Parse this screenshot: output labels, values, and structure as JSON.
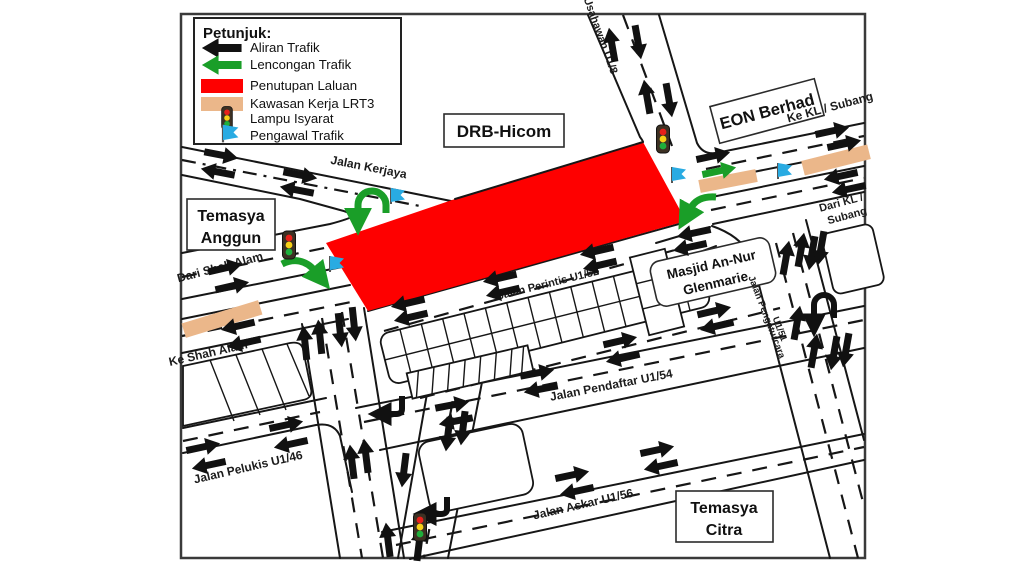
{
  "colors": {
    "closure": "#fe0000",
    "lrt3": "#ebb78a",
    "diversion": "#1a9e28",
    "flag": "#29abe2",
    "ink": "#161616"
  },
  "legend": {
    "title": "Petunjuk:",
    "items": [
      {
        "label": "Aliran Trafik",
        "swatch": "black-arrow-icon"
      },
      {
        "label": "Lencongan Trafik",
        "swatch": "green-arrow-icon"
      },
      {
        "label": "Penutupan Laluan",
        "swatch": "red-swatch"
      },
      {
        "label": "Kawasan Kerja LRT3",
        "swatch": "tan-swatch"
      },
      {
        "label": "Lampu Isyarat",
        "swatch": "traffic-light-icon"
      },
      {
        "label": "Pengawal Trafik",
        "swatch": "flag-icon"
      }
    ]
  },
  "places": {
    "drb_hicom": "DRB-Hicom",
    "eon_berhad": "EON Berhad",
    "temasya_anggun": [
      "Temasya",
      "Anggun"
    ],
    "temasya_citra": [
      "Temasya",
      "Citra"
    ],
    "masjid": [
      "Masjid An-Nur",
      "Glenmarie"
    ]
  },
  "road_labels": {
    "kerjaya": "Jalan Kerjaya",
    "usahawan": "Jalan Usahawan U1/8",
    "ke_kl": "Ke KL / Subang",
    "dari_kl_line1": "Dari KL /",
    "dari_kl_line2": "Subang",
    "dari_shah_alam": "Dari Shah Alam",
    "ke_shah_alam": "Ke Shah Alam",
    "perintis": "Jalan Perintis U1/52",
    "pendaftar": "Jalan Pendaftar U1/54",
    "pengaturcara_line1": "Jalan Pengaturcara",
    "pengaturcara_line2": "U1/51",
    "pelukis": "Jalan Pelukis U1/46",
    "askar": "Jalan Askar U1/56"
  },
  "markers": {
    "black_arrows": [
      [
        221,
        155,
        11
      ],
      [
        218,
        172,
        191
      ],
      [
        300,
        175,
        11
      ],
      [
        297,
        190,
        191
      ],
      [
        225,
        268,
        -13
      ],
      [
        232,
        286,
        -13
      ],
      [
        238,
        326,
        167
      ],
      [
        244,
        343,
        167
      ],
      [
        612,
        45,
        -100
      ],
      [
        638,
        42,
        80
      ],
      [
        647,
        97,
        -100
      ],
      [
        669,
        100,
        80
      ],
      [
        713,
        156,
        -12
      ],
      [
        832,
        131,
        -12
      ],
      [
        844,
        144,
        -12
      ],
      [
        841,
        176,
        168
      ],
      [
        849,
        189,
        168
      ],
      [
        694,
        233,
        168
      ],
      [
        690,
        247,
        168
      ],
      [
        786,
        258,
        -80
      ],
      [
        801,
        250,
        -80
      ],
      [
        812,
        253,
        100
      ],
      [
        821,
        248,
        100
      ],
      [
        797,
        323,
        -80
      ],
      [
        814,
        351,
        -80
      ],
      [
        834,
        353,
        100
      ],
      [
        846,
        350,
        100
      ],
      [
        408,
        303,
        167
      ],
      [
        411,
        317,
        167
      ],
      [
        500,
        278,
        167
      ],
      [
        503,
        292,
        167
      ],
      [
        597,
        251,
        167
      ],
      [
        600,
        265,
        167
      ],
      [
        620,
        341,
        -13
      ],
      [
        623,
        358,
        167
      ],
      [
        714,
        311,
        -13
      ],
      [
        717,
        326,
        167
      ],
      [
        452,
        405,
        -11
      ],
      [
        456,
        421,
        169
      ],
      [
        537,
        373,
        -11
      ],
      [
        541,
        389,
        169
      ],
      [
        572,
        475,
        -12
      ],
      [
        577,
        491,
        168
      ],
      [
        657,
        450,
        -12
      ],
      [
        661,
        466,
        168
      ],
      [
        286,
        425,
        -12
      ],
      [
        291,
        444,
        168
      ],
      [
        203,
        447,
        -12
      ],
      [
        209,
        465,
        168
      ],
      [
        305,
        343,
        -96
      ],
      [
        320,
        337,
        -96
      ],
      [
        340,
        330,
        84
      ],
      [
        354,
        324,
        84
      ],
      [
        352,
        462,
        -97
      ],
      [
        366,
        456,
        -97
      ],
      [
        388,
        540,
        -97
      ],
      [
        448,
        434,
        97
      ],
      [
        463,
        428,
        97
      ],
      [
        404,
        470,
        97
      ],
      [
        419,
        544,
        -83
      ]
    ],
    "green_arrows": [
      [
        719,
        171,
        -12
      ]
    ],
    "traffic_lights": [
      [
        289,
        245
      ],
      [
        663,
        139
      ],
      [
        420,
        527
      ]
    ],
    "flags": [
      [
        391,
        201
      ],
      [
        330,
        269
      ],
      [
        672,
        180
      ],
      [
        778,
        176
      ]
    ],
    "lrt3_zones": [
      [
        222,
        319,
        80,
        15,
        -17
      ],
      [
        728,
        181,
        58,
        13,
        -11
      ],
      [
        836,
        160,
        68,
        15,
        -14
      ]
    ]
  }
}
